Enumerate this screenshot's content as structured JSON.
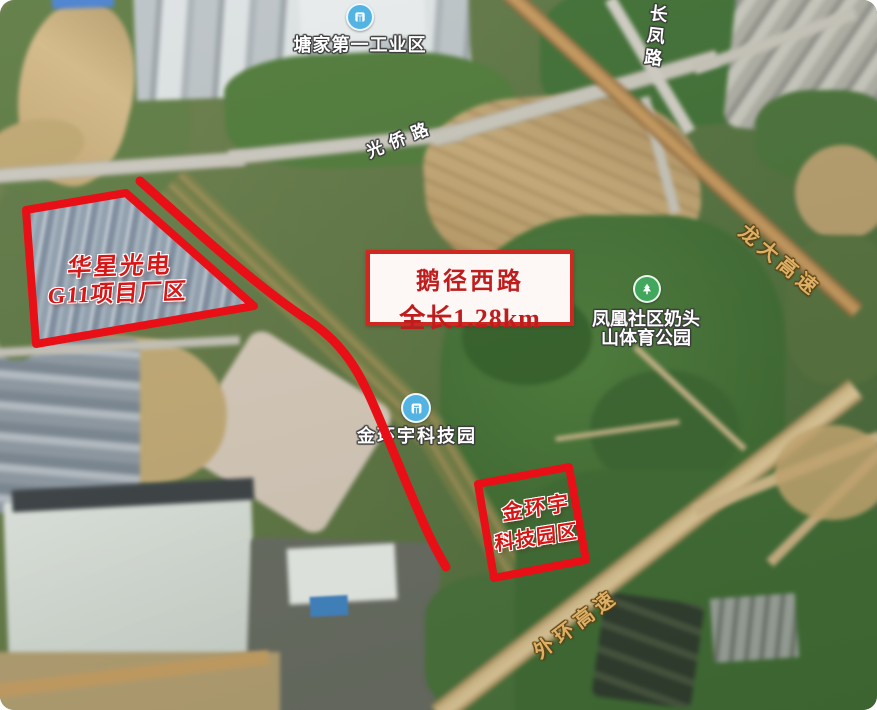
{
  "info_box": {
    "road_name": "鹅径西路",
    "length_text": "全长1.28km"
  },
  "areas": {
    "huaxing": {
      "line1": "华星光电",
      "line2": "G11项目厂区"
    },
    "jinhuanyu": {
      "line1": "金环宇",
      "line2": "科技园区"
    }
  },
  "pois": {
    "tangjia": {
      "name": "塘家第一工业区",
      "icon": "metro-station-icon"
    },
    "jinhuanyu_park": {
      "name": "金环宇科技园",
      "icon": "metro-station-icon"
    },
    "fenghuang": {
      "line1": "凤凰社区奶头",
      "line2": "山体育公园",
      "icon": "park-icon"
    }
  },
  "roads": {
    "guangqiao": {
      "name": "光侨路",
      "type": "road"
    },
    "changfeng": {
      "name": "长凤路",
      "type": "road"
    },
    "longda": {
      "name": "龙大高速",
      "type": "highway"
    },
    "waihuan": {
      "name": "外环高速",
      "type": "highway"
    }
  },
  "colors": {
    "annotation_red": "#e90f16",
    "info_box_border": "#cf2820",
    "info_box_background": "#fdf8f5",
    "info_box_text": "#bf1d1d",
    "road_label_white": "#ffffff",
    "highway_label_gold": "#ddb066",
    "metro_icon_blue": "#53b4e4",
    "park_icon_green": "#41a75c"
  }
}
